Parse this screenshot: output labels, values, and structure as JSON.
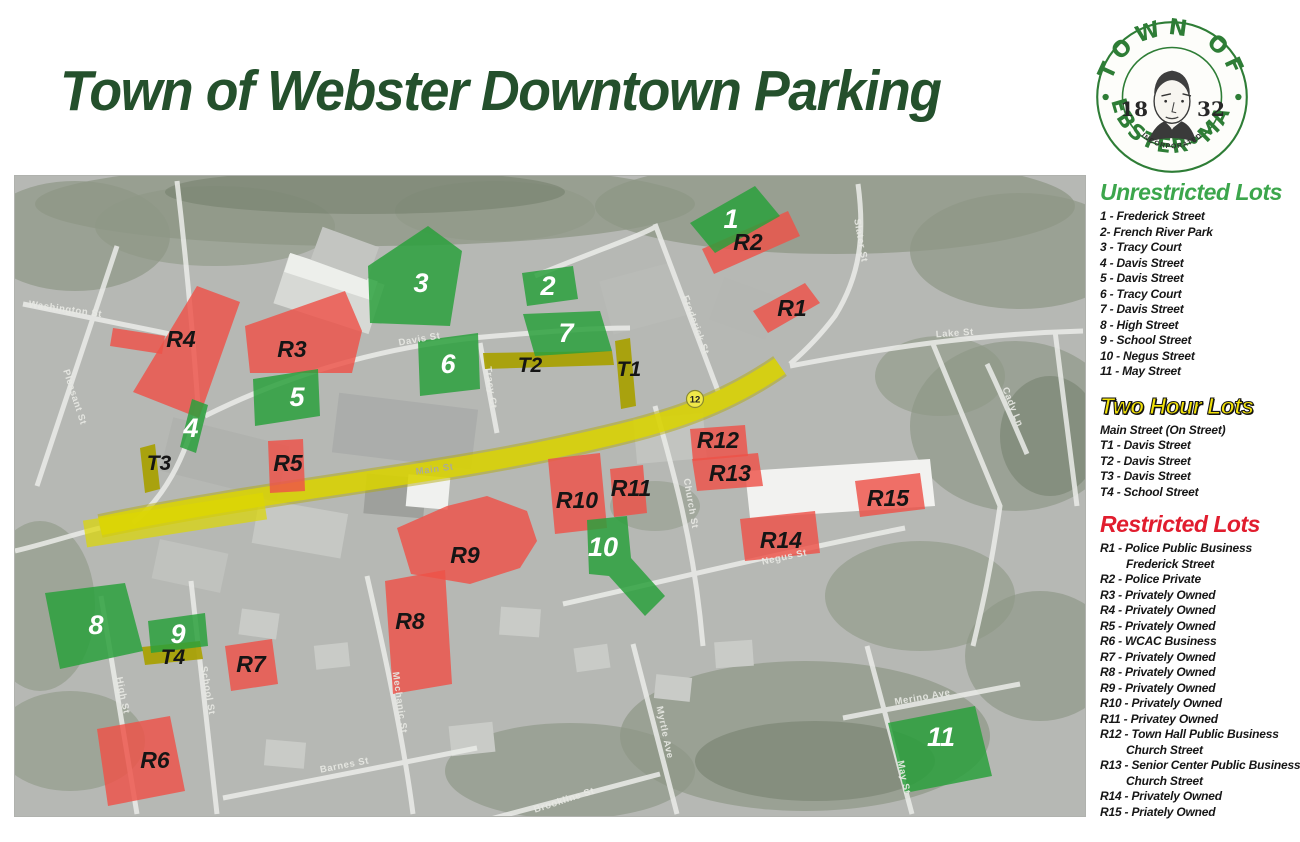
{
  "title": "Town of Webster Downtown Parking",
  "theme": {
    "title_color": "#24502c",
    "heading_green": "#3ca64c",
    "heading_yellow": "#f2e20a",
    "heading_red": "#e11d2e"
  },
  "logo": {
    "arc_top": "TOWN OF",
    "arc_bottom": "WEBSTER•MASS",
    "year_left": "18",
    "year_right": "32",
    "incorporated": "INCORPORATED"
  },
  "map": {
    "colors": {
      "unrestricted": "#2aa03c",
      "two_hour": "#a8a000",
      "restricted": "#ee5248",
      "main_street": "#ddd700"
    },
    "route_badge": "12",
    "streets": {
      "main": "Main St",
      "davis": "Davis St",
      "tracy": "Tracy Ct",
      "frederick": "Frederick St",
      "slater": "Slater St",
      "lake": "Lake St",
      "cady": "Cady Ln",
      "church": "Church St",
      "negus": "Negus St",
      "school": "School St",
      "high": "High St",
      "mechanic": "Mechanic St",
      "barnes": "Barnes St",
      "myrtle": "Myrtle Ave",
      "may": "May St",
      "merino": "Merino Ave",
      "washington": "Washington St",
      "pleasant": "Pleasant St",
      "brookline": "Brookline St"
    },
    "lots": {
      "g1": "1",
      "g2": "2",
      "g3": "3",
      "g4": "4",
      "g5": "5",
      "g6": "6",
      "g7": "7",
      "g8": "8",
      "g9": "9",
      "g10": "10",
      "g11": "11",
      "t1": "T1",
      "t2": "T2",
      "t3": "T3",
      "t4": "T4",
      "r1": "R1",
      "r2": "R2",
      "r3": "R3",
      "r4": "R4",
      "r5": "R5",
      "r6": "R6",
      "r7": "R7",
      "r8": "R8",
      "r9": "R9",
      "r10": "R10",
      "r11": "R11",
      "r12": "R12",
      "r13": "R13",
      "r14": "R14",
      "r15": "R15"
    }
  },
  "legend": {
    "unrestricted": {
      "title": "Unrestricted Lots",
      "color": "#3ca64c",
      "items": [
        "1 - Frederick Street",
        "2- French River Park",
        "3 - Tracy Court",
        "4 - Davis Street",
        "5 - Davis Street",
        "6 - Tracy Court",
        "7 - Davis Street",
        "8 - High Street",
        "9 - School Street",
        "10 - Negus Street",
        "11 - May Street"
      ]
    },
    "two_hour": {
      "title": "Two Hour Lots",
      "color": "#f2e20a",
      "items": [
        "Main Street (On Street)",
        "T1 - Davis Street",
        "T2 - Davis Street",
        "T3 - Davis Street",
        "T4 - School Street"
      ]
    },
    "restricted": {
      "title": "Restricted Lots",
      "color": "#e11d2e",
      "items": [
        {
          "t": "R1 - Police Public Business",
          "sub": "Frederick Street"
        },
        {
          "t": "R2 - Police Private"
        },
        {
          "t": "R3 - Privately Owned"
        },
        {
          "t": "R4 - Privately Owned"
        },
        {
          "t": "R5 - Privately Owned"
        },
        {
          "t": "R6 - WCAC Business"
        },
        {
          "t": "R7 - Privately Owned"
        },
        {
          "t": "R8 - Privately Owned"
        },
        {
          "t": "R9 - Privately Owned"
        },
        {
          "t": "R10 - Privately Owned"
        },
        {
          "t": "R11 - Privatey Owned"
        },
        {
          "t": "R12 - Town Hall Public Business",
          "sub": "Church Street"
        },
        {
          "t": "R13 - Senior Center Public Business",
          "sub": "Church Street"
        },
        {
          "t": "R14 - Privately Owned"
        },
        {
          "t": "R15 - Priately Owned"
        }
      ]
    }
  }
}
